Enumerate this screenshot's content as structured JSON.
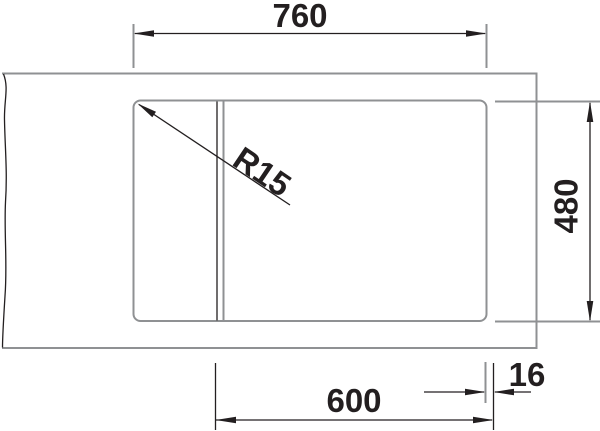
{
  "colors": {
    "line-dark": "#231f20",
    "line-gray": "#8f9193",
    "bg": "#ffffff"
  },
  "drawing": {
    "labels": {
      "width": "760",
      "depth": "480",
      "cabinet_width": "600",
      "edge_offset": "16",
      "corner_radius": "R15"
    }
  }
}
